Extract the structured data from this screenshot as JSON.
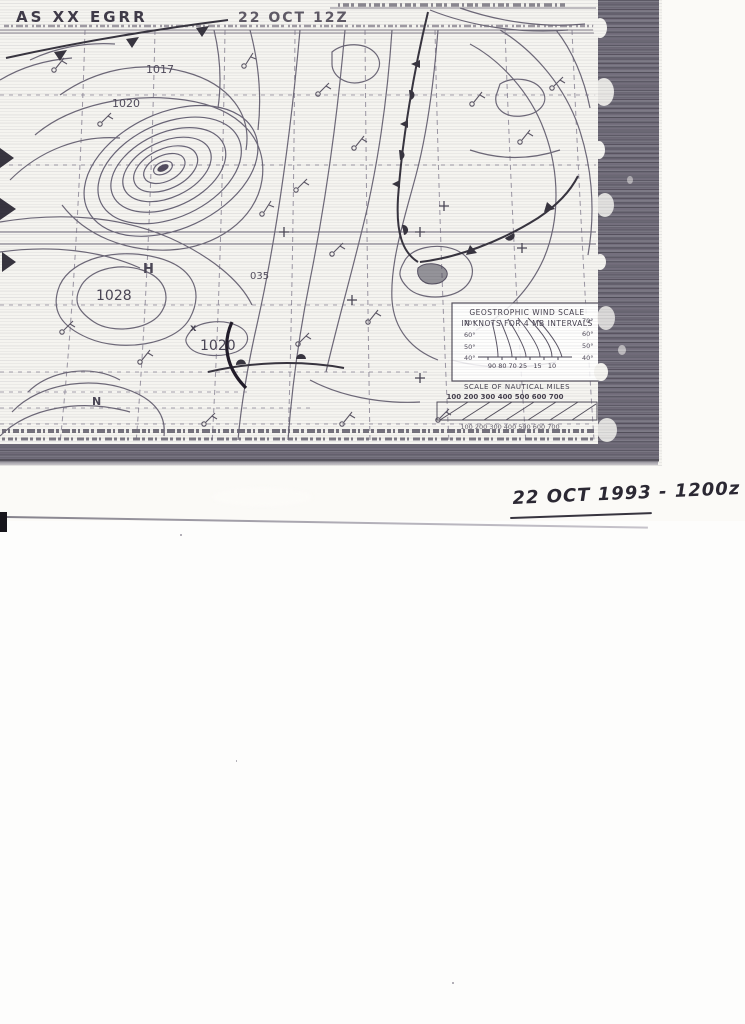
{
  "scan": {
    "fax_header": {
      "left": "AS XX EGRR",
      "center": "22 OCT 12Z"
    },
    "labels": {
      "nw_1017": "1017",
      "nw_1020": "1020",
      "h_symbol": "H",
      "high_1028": "1028",
      "x_mark": "x",
      "se_1020": "1020",
      "station_035": "035",
      "sw_n": "N"
    },
    "wind_scale": {
      "title": "GEOSTROPHIC WIND SCALE",
      "subtitle": "IN KNOTS FOR 4 MB INTERVALS",
      "lat_left": [
        "70°",
        "60°",
        "50°",
        "40°"
      ],
      "lat_right": [
        "70°",
        "60°",
        "50°",
        "40°"
      ],
      "speeds": "90 80 70 25   15   10"
    },
    "distance_scale": {
      "title": "SCALE OF NAUTICAL MILES",
      "ticks": "100 200 300 400 500 600 700",
      "ticks_bottom": "100 200 300 400 500 600 700"
    }
  },
  "annotation": {
    "handwritten_date": "22 OCT 1993 - 1200z"
  }
}
